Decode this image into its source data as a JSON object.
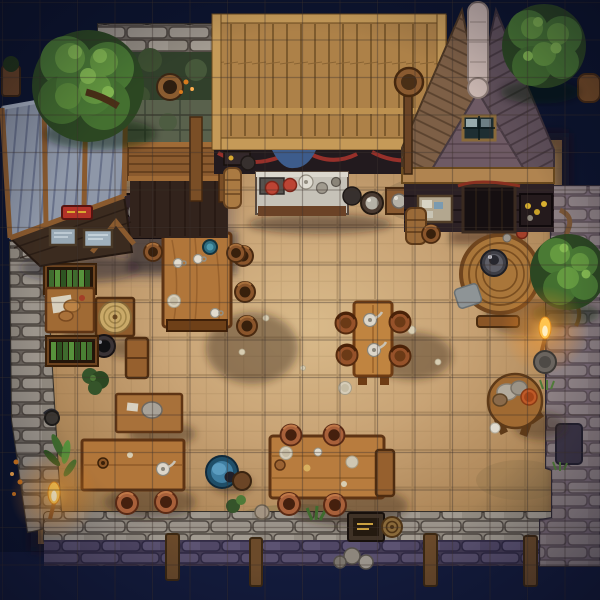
{
  "map": {
    "type": "top-down-tavern-battlemap",
    "setting": "pixel-art tavern interior at night, stone perimeter walls, torch-lit",
    "grid": {
      "columns": 16,
      "rows": 16,
      "cell_px": 37.5,
      "offset_px": 2.5,
      "line_color_dark": "rgba(42,28,14,0.33)",
      "line_color_light": "rgba(172,186,222,0.09)"
    },
    "palette": {
      "night_sky": "#0c142e",
      "water": "#131b3c",
      "floor_light": "#d9ba8a",
      "floor_mid": "#c6a375",
      "floor_dark": "#97764a",
      "stone_light": "#9b948b",
      "stone_dark": "#6a635c",
      "stone_purple": "#433b54",
      "roof_planks": "#ad8148",
      "roof_slate": "#8e97a8",
      "gable_brown": "#7d5f46",
      "gable_mauve": "#60505a",
      "ridge_cap": "#c9b6b0",
      "table_wood": "#b1763a",
      "foliage_dark": "#2c4722",
      "foliage_mid": "#4a7a34",
      "foliage_light": "#659a40",
      "torch_flame": "#ffc44e",
      "sign_red": "#b23228",
      "cloth_blue": "#3d5c8c",
      "basin_blue": "#3f7da0"
    },
    "torches": [
      {
        "x": 54,
        "y": 495
      },
      {
        "x": 545,
        "y": 330
      }
    ],
    "trees": [
      {
        "name": "tree-top-left",
        "x": 88,
        "y": 86,
        "r": 56
      },
      {
        "name": "tree-top-right",
        "x": 544,
        "y": 46,
        "r": 40
      },
      {
        "name": "tree-right-wall",
        "x": 568,
        "y": 272,
        "r": 36
      }
    ],
    "seating": {
      "brown_stools": [
        {
          "x": 243,
          "y": 256,
          "s": 1
        },
        {
          "x": 245,
          "y": 292,
          "s": 1
        },
        {
          "x": 247,
          "y": 326,
          "s": 1
        },
        {
          "x": 153,
          "y": 252,
          "s": 0.9
        },
        {
          "x": 236,
          "y": 253,
          "s": 0.9
        },
        {
          "x": 431,
          "y": 234,
          "s": 0.9
        }
      ],
      "terracotta_stools": [
        {
          "x": 127,
          "y": 503,
          "s": 1
        },
        {
          "x": 166,
          "y": 502,
          "s": 1
        },
        {
          "x": 291,
          "y": 435,
          "s": 0.95
        },
        {
          "x": 334,
          "y": 435,
          "s": 0.95
        },
        {
          "x": 289,
          "y": 504,
          "s": 1
        },
        {
          "x": 335,
          "y": 505,
          "s": 1
        }
      ],
      "round_chairs": [
        {
          "x": 346,
          "y": 323,
          "s": 1
        },
        {
          "x": 347,
          "y": 355,
          "s": 1
        },
        {
          "x": 400,
          "y": 322,
          "s": 1
        },
        {
          "x": 400,
          "y": 356,
          "s": 1
        }
      ]
    },
    "structures": [
      "stone-perimeter-wall",
      "left-lean-to-roof",
      "plank-walkway",
      "main-plank-roof",
      "gabled-house",
      "bar-counter",
      "garden-bed",
      "water-moat"
    ],
    "furniture": [
      "big-dining-table",
      "tea-table",
      "round-cask-table",
      "side-round-table",
      "left-long-table",
      "small-side-table",
      "center-long-table",
      "food-table",
      "tray-table",
      "bookshelf",
      "bookshelf",
      "bench",
      "wash-basin",
      "cauldron",
      "storage-barrel",
      "crate",
      "notice-board",
      "red-sign"
    ]
  }
}
